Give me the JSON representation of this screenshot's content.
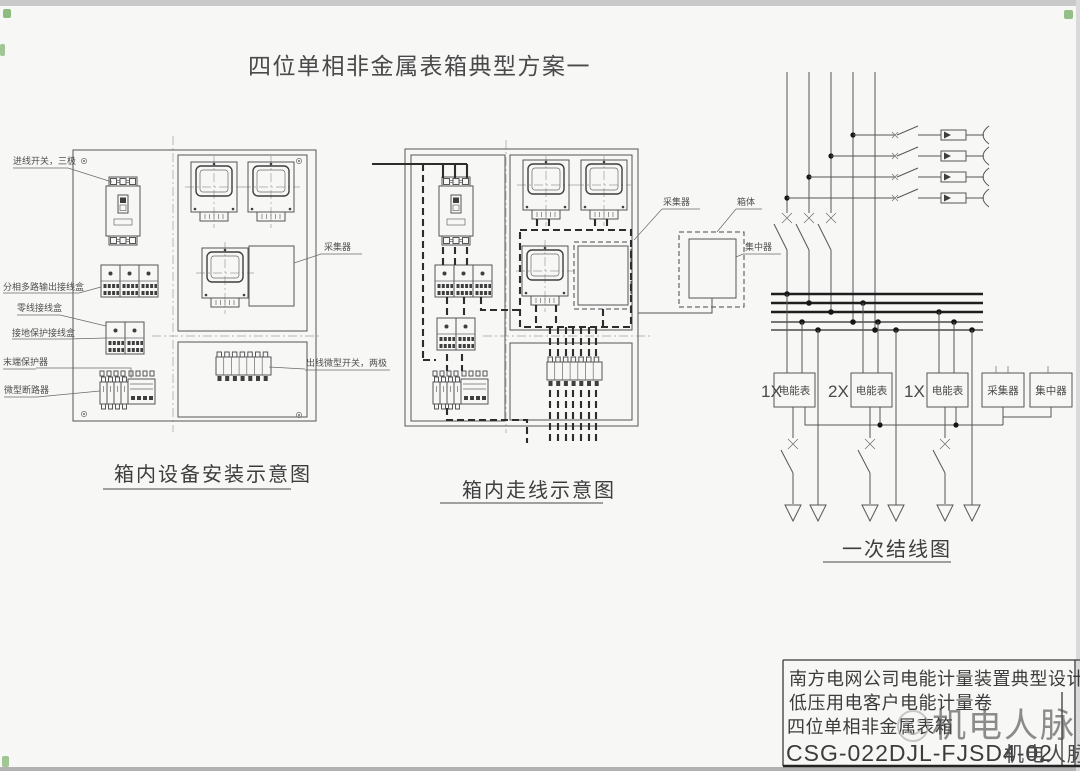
{
  "page": {
    "title": "四位单相非金属表箱典型方案一",
    "watermark": "机电人脉",
    "corner_mark": "机电人脉"
  },
  "install_diagram": {
    "caption": "箱内设备安装示意图",
    "labels": {
      "incoming_switch": "进线开关，三极",
      "multi_output_box": "分相多路输出接线盒",
      "neutral_box": "零线接线盒",
      "ground_box": "接地保护接线盒",
      "end_protector": "末端保护器",
      "mini_breaker": "微型断路器",
      "collector": "采集器",
      "outgoing_switch": "出线微型开关，两极"
    }
  },
  "wiring_diagram": {
    "caption": "箱内走线示意图"
  },
  "oneline_diagram": {
    "caption": "一次结线图",
    "labels": {
      "collector": "采集器",
      "box_body": "箱体",
      "concentrator": "集中器"
    },
    "devices": [
      {
        "qty": "1X",
        "name": "电能表"
      },
      {
        "qty": "2X",
        "name": "电能表"
      },
      {
        "qty": "1X",
        "name": "电能表"
      },
      {
        "qty": "",
        "name": "采集器"
      },
      {
        "qty": "",
        "name": "集中器"
      }
    ]
  },
  "title_block": {
    "line1": "南方电网公司电能计量装置典型设计",
    "line2": "低压用电客户电能计量卷",
    "line3": "四位单相非金属表箱",
    "drawing_no": "CSG-022DJL-FJSD4-02"
  },
  "colors": {
    "line": "#565656",
    "accent_red": "#b0413c",
    "watermark": "#ababab"
  }
}
